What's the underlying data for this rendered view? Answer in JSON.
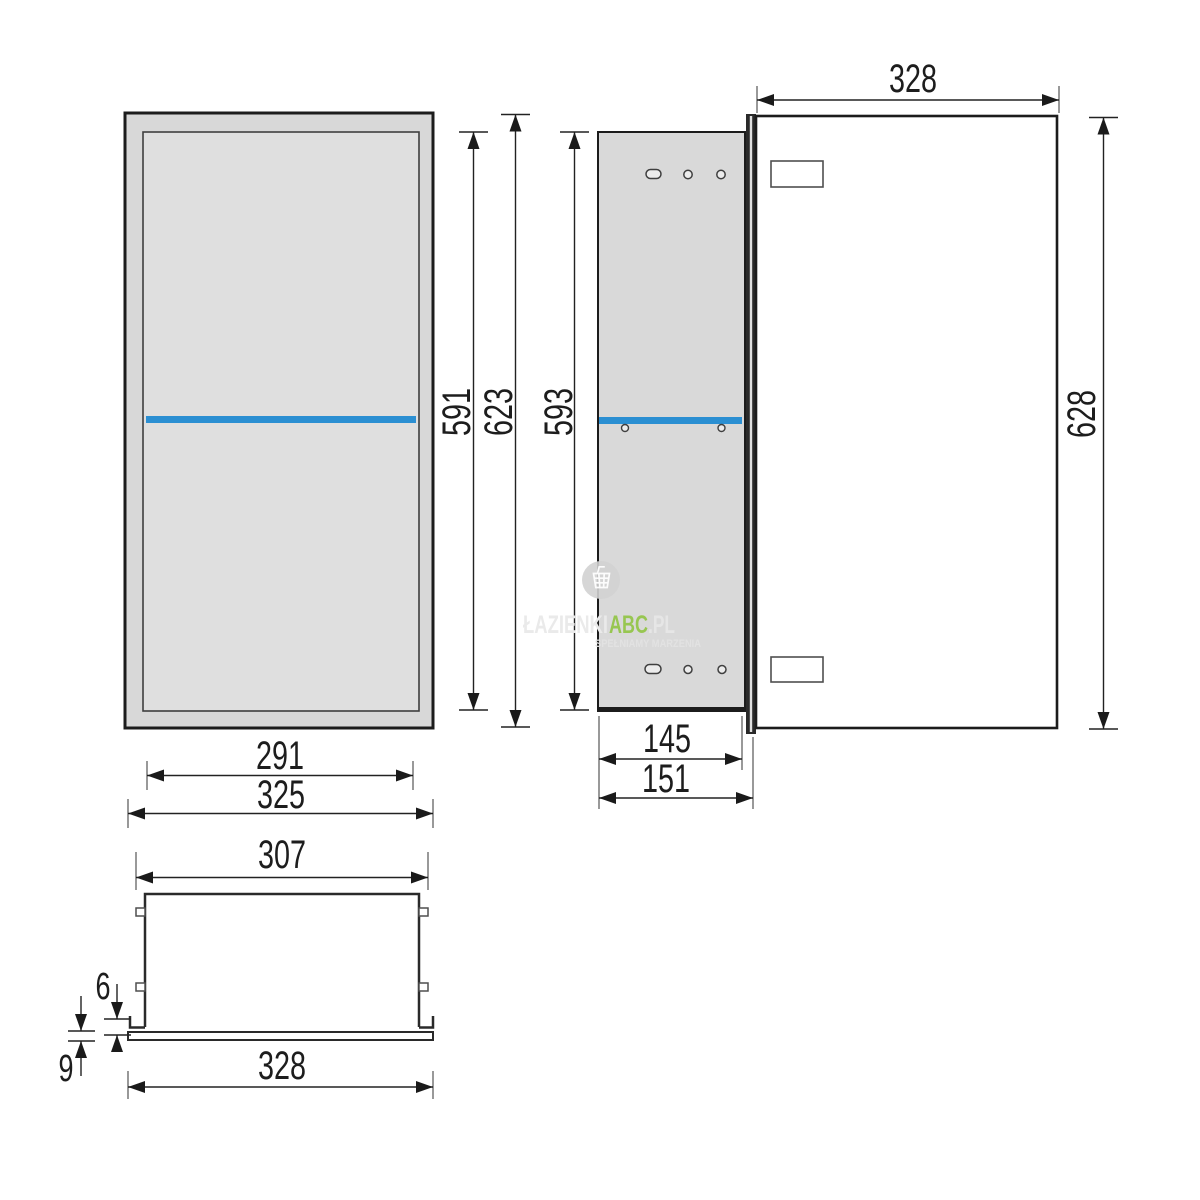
{
  "drawing": {
    "type": "cabinet-technical-drawing",
    "colors": {
      "shelf_blue": "#2b8fd2",
      "panel_gray": "#d9d9d9",
      "line_dark": "#1f1f1f",
      "brand_green": "#8fc43f"
    },
    "dims": {
      "front": {
        "inner_width": "291",
        "outer_width": "325",
        "inner_height": "591",
        "outer_height": "623"
      },
      "side": {
        "height": "593",
        "depth_body": "145",
        "depth_total": "151"
      },
      "door": {
        "width": "328",
        "height": "628"
      },
      "bottom": {
        "body_width": "307",
        "overall_width": "328",
        "lip_height": "6",
        "base_offset": "9"
      }
    },
    "watermark": {
      "brand_prefix": "ŁAZIENKI",
      "brand_main": "ABC",
      "brand_suffix": ".PL",
      "tagline": "SPEŁNIAMY MARZENIA"
    }
  }
}
